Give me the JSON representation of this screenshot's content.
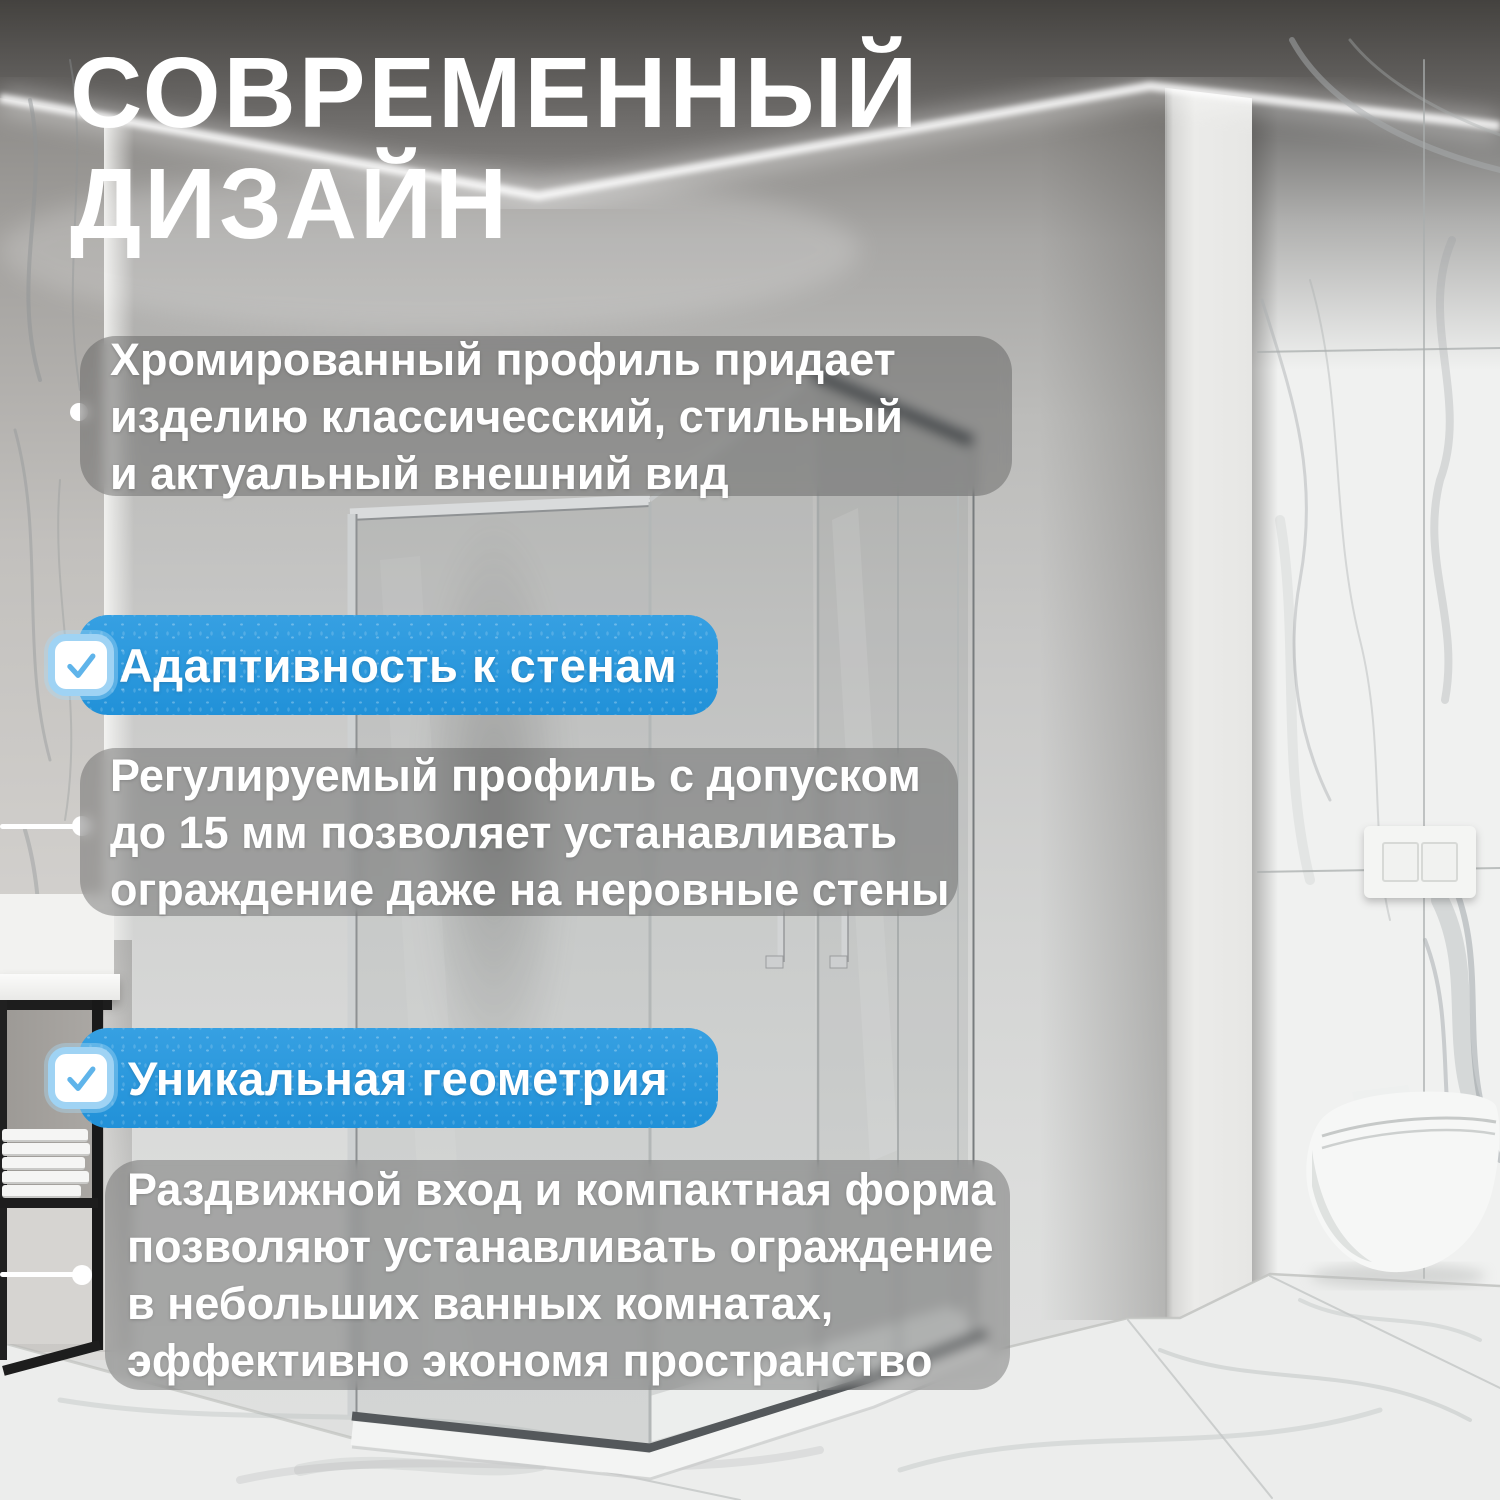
{
  "title": {
    "lines": [
      "СОВРЕМЕННЫЙ",
      "ДИЗАЙН"
    ]
  },
  "features": [
    {
      "kind": "paragraph",
      "marker": "dot",
      "lines": [
        "Хромированный профиль придает",
        "изделию классичесский, стильный",
        "и актуальный внешний вид"
      ]
    },
    {
      "kind": "badge",
      "icon": "checkbox-check-icon",
      "label": "Адаптивность к стенам"
    },
    {
      "kind": "paragraph",
      "marker": "edge-line-dot",
      "lines": [
        "Регулируемый профиль с допуском",
        "до 15 мм позволяет устанавливать",
        "ограждение даже на неровные стены"
      ]
    },
    {
      "kind": "badge",
      "icon": "checkbox-check-icon",
      "label": "Уникальная геометрия"
    },
    {
      "kind": "paragraph",
      "marker": "edge-line-dot",
      "lines": [
        "Раздвижной вход и компактная форма",
        "позволяют устанавливать ограждение",
        "в небольших ванных комнатах,",
        "эффективно экономя пространство"
      ]
    }
  ],
  "colors": {
    "accent_blue": "#2191d8",
    "accent_blue_light": "#36a0e2",
    "check_blue": "#5fb4ea",
    "checkbox_border": "#9fd3f4",
    "text_white": "#ffffff",
    "panel_overlay": "#3a3a3a"
  },
  "scene": {
    "objects": [
      "bathroom-cove-light-ceiling",
      "marble-walls",
      "corner-shower-enclosure-chrome-profile",
      "glass-sliding-doors",
      "door-handles",
      "white-shower-tray",
      "wall-hung-toilet",
      "flush-plate",
      "black-shelf-with-towels",
      "marble-floor"
    ]
  }
}
